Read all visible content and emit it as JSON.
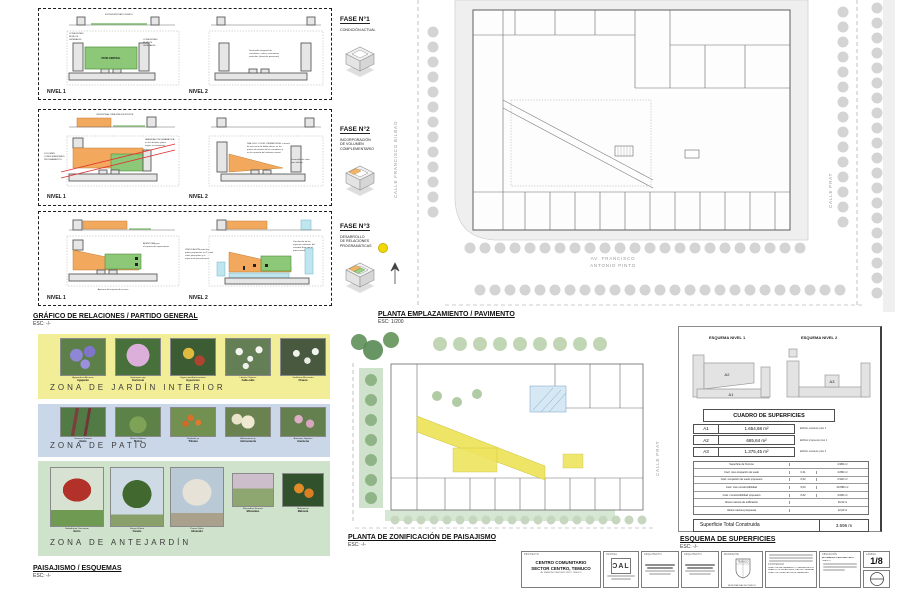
{
  "sections": {
    "grafico": {
      "title": "GRÁFICO DE RELACIONES / PARTIDO GENERAL",
      "esc": "ESC: -/-"
    },
    "emplazamiento": {
      "title": "PLANTA EMPLAZAMIENTO / PAVIMENTO",
      "esc": "ESC: 1/200"
    },
    "paisajismo": {
      "title": "PAISAJISMO / ESQUEMAS",
      "esc": "ESC: -/-"
    },
    "zonificacion": {
      "title": "PLANTA DE ZONIFICACIÓN DE PAISAJISMO",
      "esc": "ESC: -/-"
    },
    "superficies": {
      "title": "ESQUEMA DE SUPERFICIES",
      "esc": "ESC: -/-"
    }
  },
  "fases": [
    {
      "title": "FASE N°1",
      "sub1": "CONDICIÓN ACTUAL",
      "sub2": "",
      "sub3": ""
    },
    {
      "title": "FASE N°2",
      "sub1": "INCORPORACIÓN",
      "sub2": "DE VOLUMEN",
      "sub3": "COMPLEMENTARIO"
    },
    {
      "title": "FASE N°3",
      "sub1": "DESARROLLO",
      "sub2": "DE RELACIONES",
      "sub3": "PROGRAMÁTICAS"
    }
  ],
  "panel1": {
    "nivel1": "NIVEL 1",
    "nivel2": "NIVEL 2",
    "ext": "EXTENSIÓN PATIO RÍGIDO",
    "cx1": "CONEXIONES",
    "cx2": "RÍGIDOS",
    "cx3": "LATERALES",
    "patio": "PATIO CENTRAL",
    "n1": "Desarrollo ortogonal de",
    "n2": "corredores, salas y conexiones",
    "n3": "verticales (situación provisoria)"
  },
  "panel2": {
    "nivel1": "NIVEL 1",
    "nivel2": "NIVEL 2",
    "altura": "RESPETA ALTURA PRE-EXISTENTE",
    "v1": "VOLUMEN",
    "v2": "COMPLEMENTARIO",
    "v3": "PROGRAMÁTICO",
    "va1": "VARIEDAD PROGRAMÁTICA",
    "va2": "en los distintos patios",
    "va3": "según su orientación",
    "d1": "DIÁLOGO CON EL PRIMER NIVEL a través",
    "d2": "de una serie de doble alturas en los",
    "d3": "puntos de remate de los corredores y",
    "d4": "en la conexión del volumen central",
    "s1": "Desarrollo de salas",
    "s2": "para talleres"
  },
  "panel3": {
    "nivel1": "NIVEL 1",
    "nivel2": "NIVEL 2",
    "a1": "APERTURA para",
    "a2": "el espacio de exposiciones",
    "acc": "Apertura del espacio de acceso",
    "vi1": "VINCULACIÓN entre los",
    "vi2": "patios propuestos en 2° nivel,",
    "vi3": "salas principales y el",
    "vi4": "espacio de permanencia",
    "ve1": "Vinculación de los",
    "ve2": "espacios interiores del",
    "ve3": "corredor Este con el",
    "ve4": "patio central"
  },
  "site_plan": {
    "street_left": "CALLE FRANCISCO BILBAO",
    "street_right": "CALLE PRAT",
    "avenue_line1": "AV. FRANCISCO",
    "avenue_line2": "ANTONIO PINTO"
  },
  "zoning_plan": {
    "street_right": "CALLE PRAT"
  },
  "landscape": {
    "zones": [
      {
        "name": "ZONA DE JARDÍN INTERIOR",
        "color": "#f2ee97",
        "plants": [
          {
            "latin": "Agapanthus Africanus",
            "common": "Agapanto"
          },
          {
            "latin": "Hydrangea spp",
            "common": "Hortensia"
          },
          {
            "latin": "Hypericum Androsaemum",
            "common": "Hypericum"
          },
          {
            "latin": "Libertia Chilensis",
            "common": "Calle-calle"
          },
          {
            "latin": "Gaultheria Mucronata",
            "common": "Chaura"
          }
        ]
      },
      {
        "name": "ZONA DE PATIO",
        "color": "#c9d7e8",
        "plants": [
          {
            "latin": "Gunnera Tinctoria",
            "common": "Nalca"
          },
          {
            "latin": "Melica Violacea",
            "common": "Melica"
          },
          {
            "latin": "Kniphofia sp",
            "common": "Tritoma"
          },
          {
            "latin": "Alstroemeria sp",
            "common": "Alstroemeria"
          },
          {
            "latin": "Anemone Japonica",
            "common": "Anemona"
          }
        ]
      },
      {
        "name": "ZONA DE ANTEJARDÍN",
        "color": "#cfe2cb",
        "plants": [
          {
            "latin": "Embothrium Coccineum",
            "common": "Notro"
          },
          {
            "latin": "Drimys Winteri",
            "common": "Canelo"
          },
          {
            "latin": "Prunus Dulcis",
            "common": "Almendro"
          },
          {
            "latin": "Miscanthus Sinensis",
            "common": "Miscantus"
          },
          {
            "latin": "Mahonia sp",
            "common": "Mahonia"
          }
        ]
      }
    ]
  },
  "superficies_panel": {
    "esquema1": "ESQUEMA NIVEL 1",
    "esquema2": "ESQUEMA NIVEL 2",
    "labels": {
      "a1": "A1",
      "a2": "A2",
      "a3": "A3"
    },
    "cuadro_title": "CUADRO DE SUPERFICIES",
    "areas": [
      {
        "code": "A1",
        "value": "1.654,68 m²",
        "note": "Edificio existente piso 1"
      },
      {
        "code": "A2",
        "value": "665,64 m²",
        "note": "Edificio propuesto piso 1"
      },
      {
        "code": "A3",
        "value": "1.375,45 m²",
        "note": "Edificio existente piso 2"
      }
    ],
    "detail": [
      {
        "label": "Superficie de Terreno",
        "coef": "",
        "value": "4.983 m²"
      },
      {
        "label": "Coef. max ocupación de suelo",
        "coef": "0,41",
        "value": "4.080 m²"
      },
      {
        "label": "Coef. ocupación de suelo propuesto",
        "coef": "0,52",
        "value": "2.520 m²"
      },
      {
        "label": "Coef. max constructibilidad",
        "coef": "6,00",
        "value": "26.898 m²"
      },
      {
        "label": "Coef. constructibilidad propuesto",
        "coef": "0,62",
        "value": "3.696 m²"
      },
      {
        "label": "Altura maxima de edificación",
        "coef": "",
        "value": "31/10 m"
      },
      {
        "label": "Altura maxima propuesta",
        "coef": "",
        "value": "12,00 m"
      }
    ],
    "total_label": "Superficie Total Construida",
    "total_value": "3.696 m"
  },
  "titleblock": {
    "proyecto": {
      "header": "PROYECTO",
      "line1": "CENTRO COMUNITARIO",
      "line2": "SECTOR CENTRO, TEMUCO",
      "line3": "AV. FRANCISCO ANTONIO PINTO, TEMUCO"
    },
    "oficina": {
      "header": "OFICINA",
      "logo": "ƆAL"
    },
    "arquitecto1": {
      "header": "ARQUITECTO"
    },
    "arquitecto2": {
      "header": "ARQUITECTO"
    },
    "mandante": {
      "header": "MANDANTE",
      "shield": "TEMUCO",
      "line": "MUNICIPALIDAD DE TEMUCO"
    },
    "contenido": {
      "header": "CONTENIDO",
      "line1": "PLANO DE EMPLAZAMIENTO / PAVIMENTACIÓN",
      "line2": "GRÁFICO DE RELACIONES / PARTIDO GENERAL",
      "line3": "PLANO DE ZONIFICACIÓN DE PAISAJISMO"
    },
    "ubicacion": {
      "header": "UBICACIÓN",
      "line1": "AV. FRANCISCO ANTONIO PINTO",
      "line2": "TEMUCO"
    },
    "lamina": {
      "header": "LÁMINA",
      "number": "1/8"
    }
  }
}
